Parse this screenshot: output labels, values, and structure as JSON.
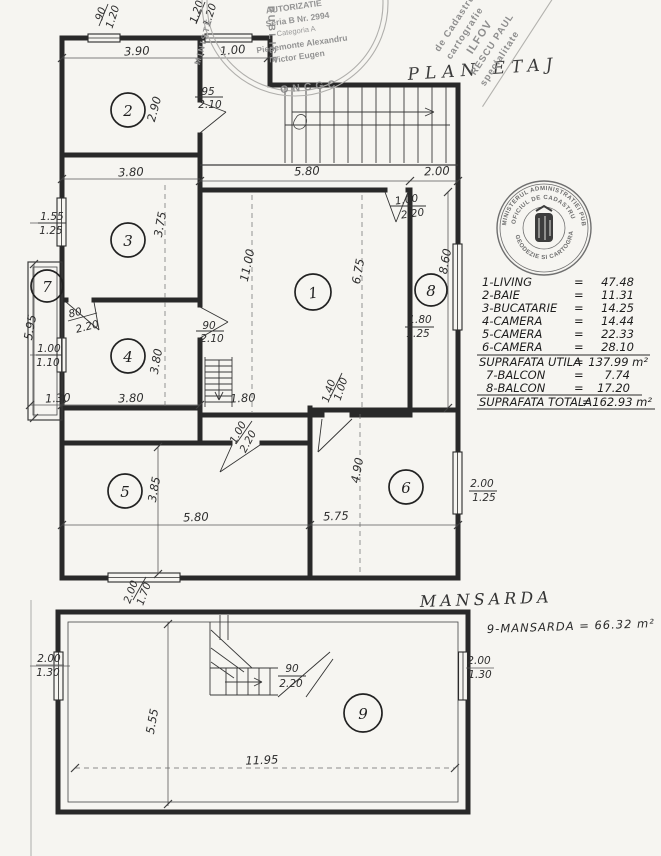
{
  "etaj": {
    "title": "PLAN ETAJ",
    "rooms": {
      "r1": "1",
      "r2": "2",
      "r3": "3",
      "r4": "4",
      "r5": "5",
      "r6": "6",
      "r7": "7",
      "r8": "8"
    },
    "dims": {
      "win_top1_w": "90",
      "win_top1_h": "1.20",
      "win_top2_w": "1.20",
      "win_top2_h": "1.20",
      "d390": "3.90",
      "d100_top": "1.00",
      "door2_w": "95",
      "door2_h": "2.10",
      "d290": "2.90",
      "d380_kitchen": "3.80",
      "win3_w": "1.55",
      "win3_h": "1.25",
      "d375": "3.75",
      "d595": "5.95",
      "door4a_w": "80",
      "door4a_h": "2.20",
      "win4_w": "1.00",
      "win4_h": "1.10",
      "d380_r4": "3.80",
      "door4b_w": "90",
      "door4b_h": "2.10",
      "d130": "1.30",
      "d380_bot": "3.80",
      "d580_top": "5.80",
      "d200_top": "2.00",
      "door1_w": "1.00",
      "door1_h": "2.20",
      "d1100": "11.00",
      "d675": "6.75",
      "d860": "8.60",
      "win8_w": "1.80",
      "win8_h": "1.25",
      "d180": "1.80",
      "door5_w": "1.00",
      "door5_h": "2.20",
      "open6_w": "1.40",
      "open6_h": "1.00",
      "d385": "3.85",
      "d580_bot": "5.80",
      "d490": "4.90",
      "d575": "5.75",
      "win6_w": "2.00",
      "win6_h": "1.25",
      "win5_w": "2.00",
      "win5_h": "1.70"
    }
  },
  "mansarda": {
    "title": "MANSARDA",
    "area_note": "9-MANSARDA = 66.32 m²",
    "room": "9",
    "dims": {
      "win_left_w": "2.00",
      "win_left_h": "1.30",
      "door_w": "90",
      "door_h": "2.20",
      "d555": "5.55",
      "d1195": "11.95",
      "win_right_w": "2.00",
      "win_right_h": "1.30"
    }
  },
  "legend": {
    "eq": "=",
    "rows": [
      {
        "label": "1-LIVING",
        "value": "47.48"
      },
      {
        "label": "2-BAIE",
        "value": "11.31"
      },
      {
        "label": "3-BUCATARIE",
        "value": "14.25"
      },
      {
        "label": "4-CAMERA",
        "value": "14.44"
      },
      {
        "label": "5-CAMERA",
        "value": "22.33"
      },
      {
        "label": "6-CAMERA",
        "value": "28.10"
      }
    ],
    "utila_label": "SUPRAFATA UTILA",
    "utila_value": "137.99 m²",
    "balcon_rows": [
      {
        "label": "7-BALCON",
        "value": "7.74"
      },
      {
        "label": "8-BALCON",
        "value": "17.20"
      }
    ],
    "totala_label": "SUPRAFATA TOTALA",
    "totala_value": "162.93 m²"
  },
  "stamps": {
    "authorization": {
      "title": "AUTORIZATIE",
      "series": "Seria B Nr. 2994",
      "category": "Categoria A",
      "name1": "Piedemonte Alexandru",
      "name2": "Victor Eugen",
      "agency": "ONCGC",
      "ring_left": "MINISTE",
      "ring_right": "PUBLICE"
    },
    "diagonal": {
      "l1": "de Cadastru",
      "l2": "cartografie",
      "l3": "ILFOV",
      "l4": "RESCU PAUL",
      "l5": "specialitate"
    },
    "round": {
      "outer": "MINISTERUL ADMINISTRATIEI PUBLICE ★",
      "inner_top": "OFICIUL DE CADASTRU",
      "inner_bottom": "GEODEZIE SI CARTOGRAFIE"
    }
  }
}
